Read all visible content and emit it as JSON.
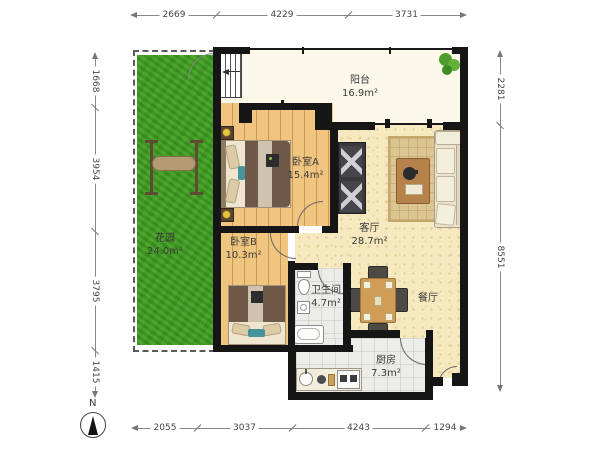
{
  "compass": {
    "label": "N"
  },
  "rooms": {
    "balcony": {
      "name": "阳台",
      "area": "16.9m²"
    },
    "bedroom_a": {
      "name": "卧室A",
      "area": "15.4m²"
    },
    "living": {
      "name": "客厅",
      "area": "28.7m²"
    },
    "garden": {
      "name": "花园",
      "area": "24.0m²"
    },
    "bedroom_b": {
      "name": "卧室B",
      "area": "10.3m²"
    },
    "bathroom": {
      "name": "卫生间",
      "area": "4.7m²"
    },
    "dining": {
      "name": "餐厅",
      "area": ""
    },
    "kitchen": {
      "name": "厨房",
      "area": "7.3m²"
    }
  },
  "dimensions": {
    "top": [
      "2669",
      "4229",
      "3731"
    ],
    "bottom": [
      "2055",
      "3037",
      "4243",
      "1294"
    ],
    "left": [
      "1668",
      "3954",
      "3795",
      "1415"
    ],
    "right": [
      "2281",
      "8551"
    ]
  },
  "colors": {
    "wall": "#161616",
    "grass_green": "#459d28",
    "wood_floor": "#f0c57f",
    "living_floor": "#f6e8bf",
    "tile_floor": "#ecece8",
    "balcony_floor": "#fbf8ea"
  }
}
